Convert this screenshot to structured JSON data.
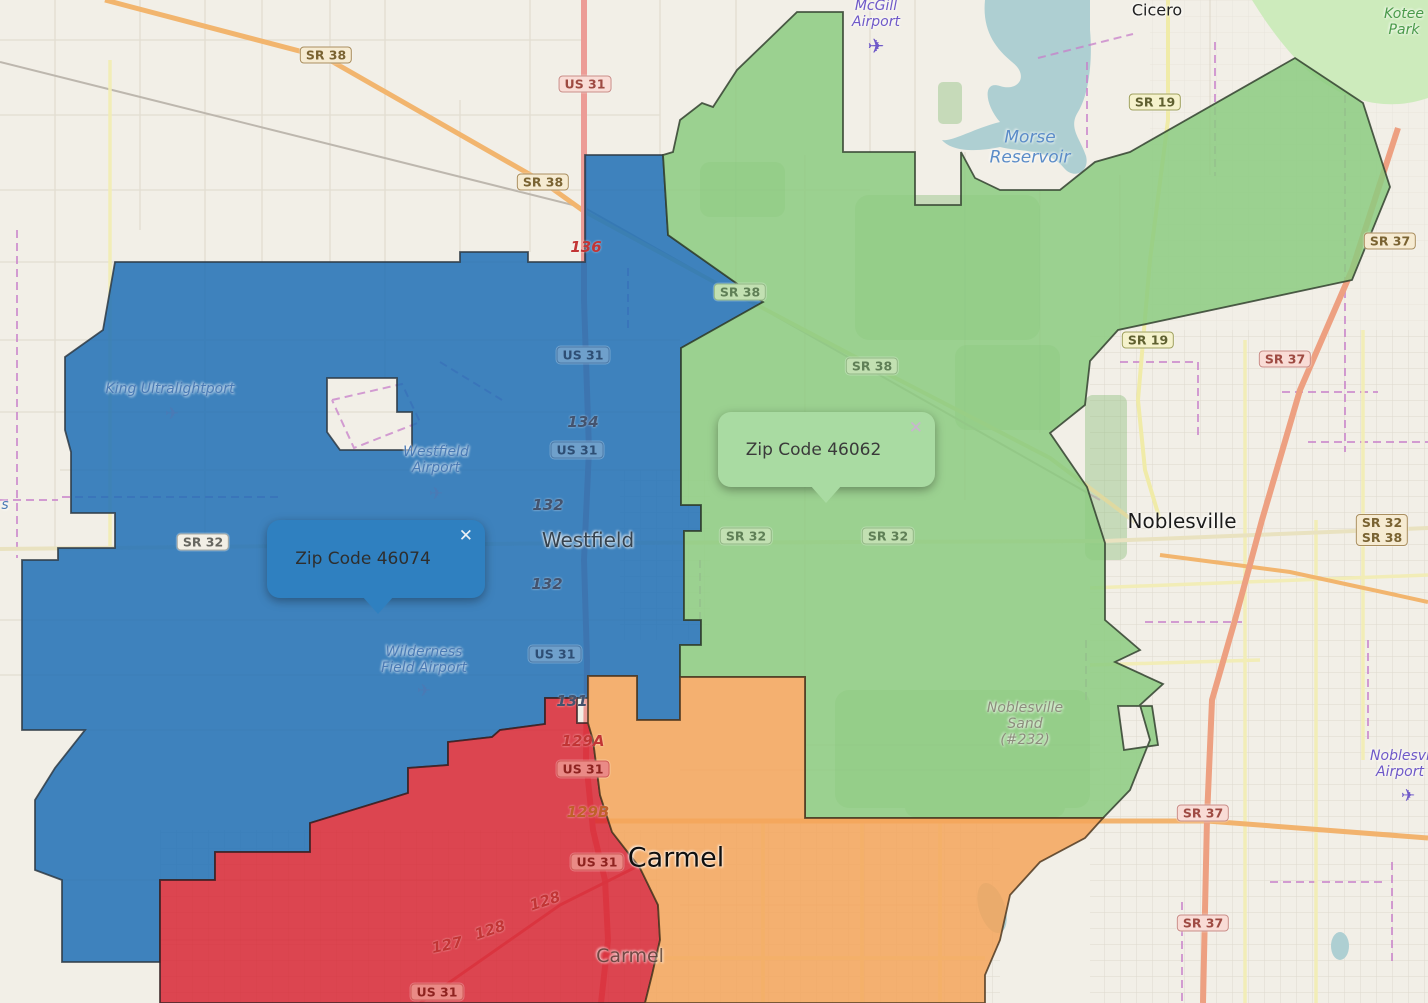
{
  "map": {
    "colors": {
      "land": "#F2EFE7",
      "water": "#AECFD2",
      "woods": "#7FB86E",
      "road_orange": "#F2B56E",
      "road_red": "#EC9C96",
      "road_yellow": "#F1ECB4",
      "boundary_purple": "#C77FC9"
    },
    "regions": [
      {
        "id": "46074",
        "label": "Zip Code 46074",
        "fill": "#1F6FB5",
        "stroke": "#2E3A44",
        "opacity": 0.85
      },
      {
        "id": "46062",
        "label": "Zip Code 46062",
        "fill": "#8CCB80",
        "stroke": "#33412F",
        "opacity": 0.85
      },
      {
        "id": "carmel-west",
        "label": "Carmel west zip region",
        "fill": "#D7202E",
        "stroke": "#3A2326",
        "opacity": 0.82
      },
      {
        "id": "carmel-east",
        "label": "Carmel east zip region",
        "fill": "#F5A55B",
        "stroke": "#503A22",
        "opacity": 0.85
      }
    ],
    "popups": [
      {
        "id": "46074",
        "label": "Zip Code 46074",
        "close_glyph": "✕",
        "bg": "#2F80C0",
        "text_color": "#2E2E2E",
        "close_color": "#ECF1F5",
        "x": 267,
        "y": 520,
        "width": 218,
        "height": 78,
        "pointer_offset": 95
      },
      {
        "id": "46062",
        "label": "Zip Code 46062",
        "close_glyph": "✕",
        "bg": "#A9DBA2",
        "text_color": "#3A3A3A",
        "close_color": "#C9B3CF",
        "x": 718,
        "y": 412,
        "width": 217,
        "height": 75,
        "pointer_offset": 92
      }
    ],
    "shield_styles": {
      "tan": {
        "bg": "#F6EBD2",
        "border": "#A98E5F",
        "text": "#7A6332"
      },
      "pink": {
        "bg": "#F9DCD6",
        "border": "#C98E88",
        "text": "#9E4A42"
      },
      "yellow": {
        "bg": "#F5F2CC",
        "border": "#9FA05E",
        "text": "#5F6030"
      },
      "gray": {
        "bg": "#F2EFE6",
        "border": "#ABABA3",
        "text": "#666660"
      },
      "blue_tint": {
        "bg": "#6FA0CB",
        "border": "#4C7AA8",
        "text": "#2E4E74"
      },
      "green_tint": {
        "bg": "#C2E0B2",
        "border": "#93B886",
        "text": "#5F7F56"
      },
      "red_tint": {
        "bg": "#EA8A86",
        "border": "#D05A56",
        "text": "#8E2320"
      }
    },
    "shields": [
      {
        "lines": [
          "SR 38"
        ],
        "x": 326,
        "y": 55,
        "style": "tan"
      },
      {
        "lines": [
          "US 31"
        ],
        "x": 585,
        "y": 84,
        "style": "pink"
      },
      {
        "lines": [
          "SR 38"
        ],
        "x": 543,
        "y": 182,
        "style": "tan"
      },
      {
        "lines": [
          "SR 19"
        ],
        "x": 1155,
        "y": 102,
        "style": "yellow"
      },
      {
        "lines": [
          "SR 37"
        ],
        "x": 1390,
        "y": 241,
        "style": "tan"
      },
      {
        "lines": [
          "SR 38"
        ],
        "x": 740,
        "y": 292,
        "style": "green_tint"
      },
      {
        "lines": [
          "SR 19"
        ],
        "x": 1148,
        "y": 340,
        "style": "yellow"
      },
      {
        "lines": [
          "SR 37"
        ],
        "x": 1285,
        "y": 359,
        "style": "pink"
      },
      {
        "lines": [
          "US 31"
        ],
        "x": 583,
        "y": 355,
        "style": "blue_tint"
      },
      {
        "lines": [
          "SR 38"
        ],
        "x": 872,
        "y": 366,
        "style": "green_tint"
      },
      {
        "lines": [
          "US 31"
        ],
        "x": 577,
        "y": 450,
        "style": "blue_tint"
      },
      {
        "lines": [
          "SR 32"
        ],
        "x": 203,
        "y": 542,
        "style": "gray"
      },
      {
        "lines": [
          "SR 32"
        ],
        "x": 746,
        "y": 536,
        "style": "green_tint"
      },
      {
        "lines": [
          "SR 32"
        ],
        "x": 888,
        "y": 536,
        "style": "green_tint"
      },
      {
        "lines": [
          "SR 32",
          "SR 38"
        ],
        "x": 1382,
        "y": 530,
        "style": "tan"
      },
      {
        "lines": [
          "US 31"
        ],
        "x": 555,
        "y": 654,
        "style": "blue_tint"
      },
      {
        "lines": [
          "US 31"
        ],
        "x": 583,
        "y": 769,
        "style": "red_tint"
      },
      {
        "lines": [
          "SR 37"
        ],
        "x": 1203,
        "y": 813,
        "style": "pink"
      },
      {
        "lines": [
          "US 31"
        ],
        "x": 597,
        "y": 862,
        "style": "red_tint"
      },
      {
        "lines": [
          "SR 37"
        ],
        "x": 1203,
        "y": 923,
        "style": "pink"
      },
      {
        "lines": [
          "US 31"
        ],
        "x": 437,
        "y": 992,
        "style": "red_tint"
      }
    ],
    "route_numbers": [
      {
        "text": "136",
        "x": 586,
        "y": 247,
        "style": "red",
        "angle": 0
      },
      {
        "text": "134",
        "x": 583,
        "y": 422,
        "style": "slate",
        "angle": 0
      },
      {
        "text": "132",
        "x": 548,
        "y": 505,
        "style": "slate",
        "angle": 0
      },
      {
        "text": "132",
        "x": 547,
        "y": 584,
        "style": "slate",
        "angle": 0
      },
      {
        "text": "131",
        "x": 572,
        "y": 701,
        "style": "slate",
        "angle": 0
      },
      {
        "text": "129A",
        "x": 583,
        "y": 741,
        "style": "red",
        "angle": 0
      },
      {
        "text": "129B",
        "x": 588,
        "y": 812,
        "style": "orange",
        "angle": 0
      },
      {
        "text": "128",
        "x": 545,
        "y": 901,
        "style": "red",
        "angle": -18
      },
      {
        "text": "128",
        "x": 490,
        "y": 930,
        "style": "red",
        "angle": -18
      },
      {
        "text": "127",
        "x": 447,
        "y": 945,
        "style": "red",
        "angle": -12
      }
    ],
    "city_labels": [
      {
        "text": "Cicero",
        "x": 1157,
        "y": 10,
        "size": 16,
        "color": "#222222",
        "opacity": 1
      },
      {
        "text": "Westfield",
        "x": 588,
        "y": 540,
        "size": 20,
        "color": "#36434F",
        "opacity": 1
      },
      {
        "text": "Noblesville",
        "x": 1182,
        "y": 521,
        "size": 20,
        "color": "#1C1C1C",
        "opacity": 1
      },
      {
        "text": "Carmel",
        "x": 676,
        "y": 858,
        "size": 27,
        "color": "#101010",
        "opacity": 1
      },
      {
        "text": "Carmel",
        "x": 630,
        "y": 956,
        "size": 19,
        "color": "#5D4A42",
        "opacity": 0.85
      }
    ],
    "poi_labels": [
      {
        "lines": [
          "McGill",
          "Airport"
        ],
        "x": 876,
        "y": 14,
        "size": 14,
        "color": "#6F59C8",
        "plane": {
          "x": 876,
          "y": 46,
          "size": 20
        }
      },
      {
        "lines": [
          "King Ultralightport"
        ],
        "x": 170,
        "y": 389,
        "size": 14,
        "color": "#4A7AB5",
        "plane": {
          "x": 172,
          "y": 414,
          "size": 17
        }
      },
      {
        "lines": [
          "Westfield",
          "Airport"
        ],
        "x": 436,
        "y": 460,
        "size": 14,
        "color": "#4A7AB5",
        "plane": {
          "x": 436,
          "y": 494,
          "size": 17
        }
      },
      {
        "lines": [
          "Wilderness",
          "Field Airport"
        ],
        "x": 424,
        "y": 660,
        "size": 14,
        "color": "#4A7AB5",
        "plane": {
          "x": 424,
          "y": 691,
          "size": 17
        }
      },
      {
        "lines": [
          "Noblesvi",
          "Airport"
        ],
        "x": 1400,
        "y": 764,
        "size": 14,
        "color": "#6F59C8",
        "plane": {
          "x": 1408,
          "y": 796,
          "size": 17
        }
      },
      {
        "lines": [
          "Morse",
          "Reservoir"
        ],
        "x": 1030,
        "y": 148,
        "size": 17,
        "color": "#5B8CC8"
      },
      {
        "lines": [
          "Kotee",
          "Park"
        ],
        "x": 1404,
        "y": 22,
        "size": 14,
        "color": "#4A9A4A"
      },
      {
        "lines": [
          "Noblesville",
          "Sand",
          "(#232)"
        ],
        "x": 1025,
        "y": 724,
        "size": 14,
        "color": "#8D8D7D"
      },
      {
        "lines": [
          "s"
        ],
        "x": 5,
        "y": 505,
        "size": 14,
        "color": "#4A7AB5"
      }
    ]
  }
}
